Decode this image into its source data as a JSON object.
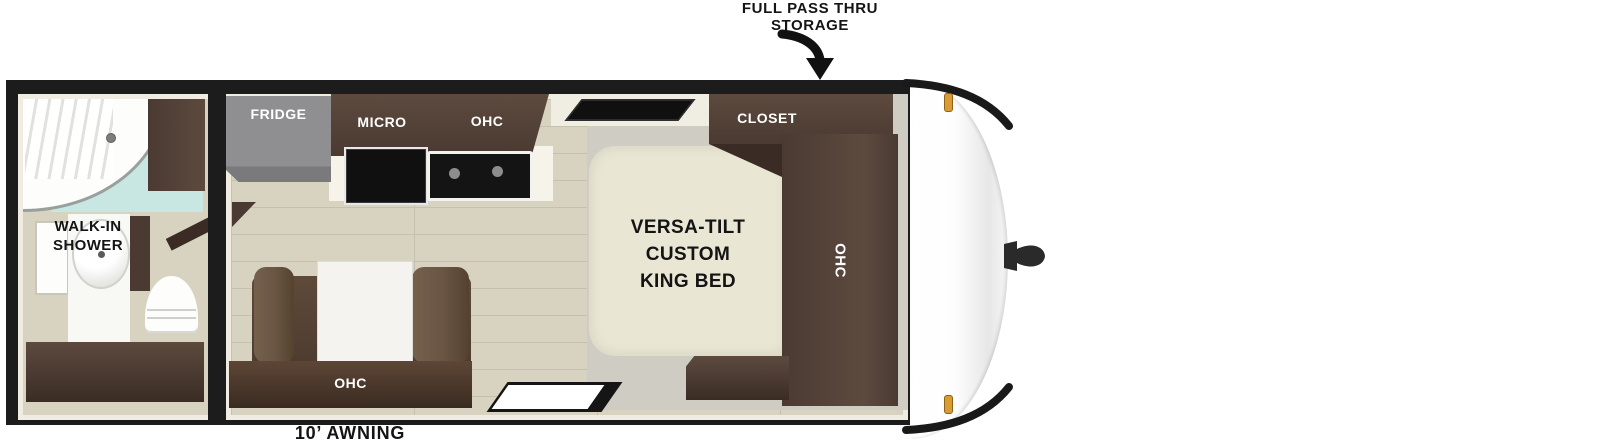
{
  "annotations": {
    "storage_line1": "FULL PASS THRU",
    "storage_line2": "STORAGE",
    "awning_label": "10’ AWNING"
  },
  "bathroom": {
    "shower_label": "WALK-IN SHOWER"
  },
  "kitchen": {
    "fridge_label": "FRIDGE",
    "micro_label": "MICRO",
    "ohc_label": "OHC"
  },
  "bedroom": {
    "closet_label": "CLOSET",
    "bed_line1": "VERSA-TILT",
    "bed_line2": "CUSTOM",
    "bed_line3": "KING BED",
    "ohc_label": "OHC"
  },
  "dinette": {
    "ohc_label": "OHC"
  },
  "colors": {
    "frame": "#1c1c1c",
    "lining": "#f0ece1",
    "floor_wood": "#d8d3c1",
    "floor_seam": "#c6c1ae",
    "floor_gray": "#cfccc4",
    "cabinet_dark": "#4a3a31",
    "cabinet_mid": "#5d4a3f",
    "cabinet_deep": "#3a2c24",
    "sofa_arm": "#6a5443",
    "bed_cream": "#eae6d4",
    "fridge_gray": "#8f8f91",
    "glass_teal": "#c9e7e2",
    "marker_amber": "#d99b33",
    "text_dark": "#141414"
  }
}
